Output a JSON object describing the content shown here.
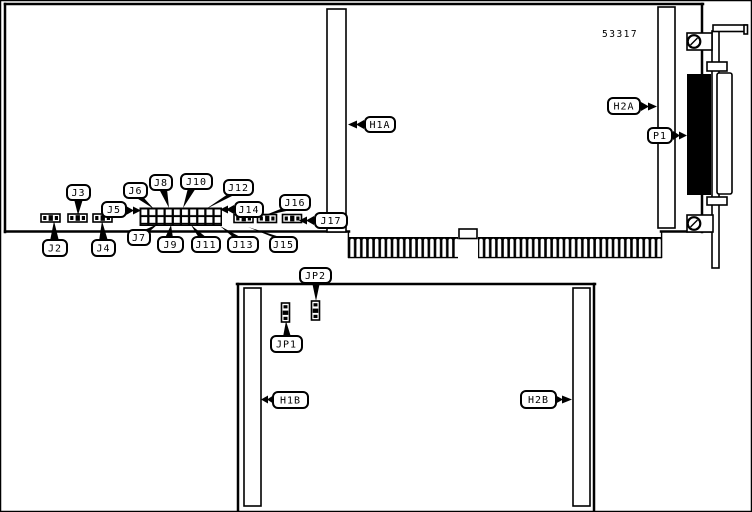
{
  "part_number": "53317",
  "callouts": {
    "j2": "J2",
    "j3": "J3",
    "j4": "J4",
    "j5": "J5",
    "j6": "J6",
    "j7": "J7",
    "j8": "J8",
    "j9": "J9",
    "j10": "J10",
    "j11": "J11",
    "j12": "J12",
    "j13": "J13",
    "j14": "J14",
    "j15": "J15",
    "j16": "J16",
    "j17": "J17",
    "h1a": "H1A",
    "h2a": "H2A",
    "p1": "P1",
    "jp1": "JP1",
    "jp2": "JP2",
    "h1b": "H1B",
    "h2b": "H2B"
  },
  "colors": {
    "ink": "#000000",
    "paper": "#ffffff"
  },
  "edge_connector": {
    "finger_groups": [
      18,
      30
    ]
  }
}
